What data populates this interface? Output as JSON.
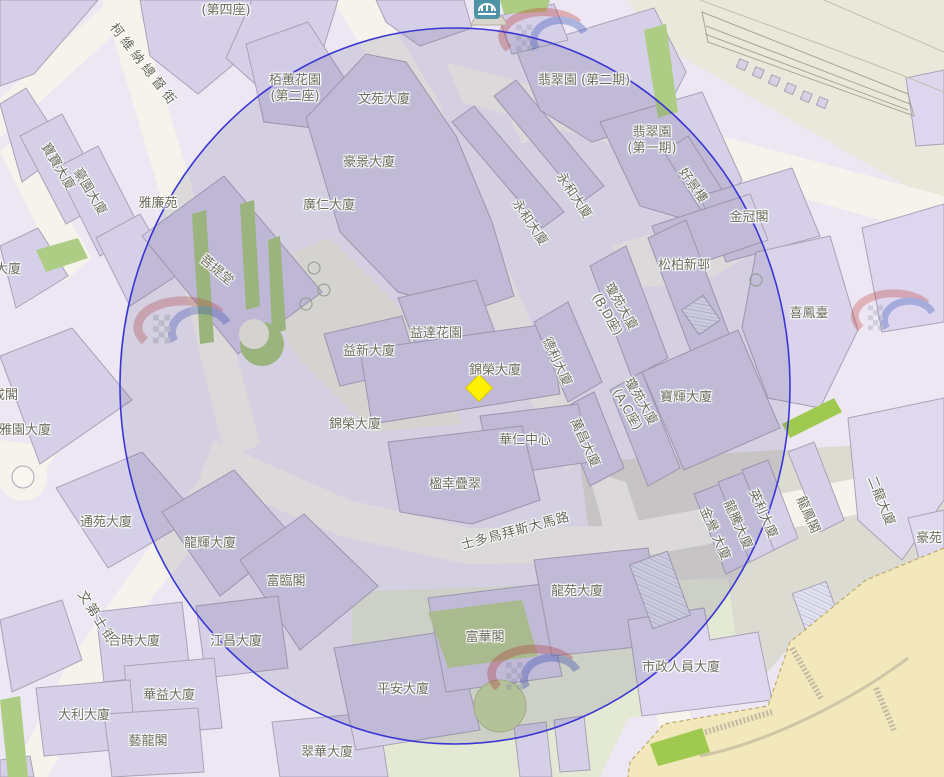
{
  "map": {
    "circle": {
      "cx": 455,
      "cy": 386,
      "rx": 335,
      "ry": 358,
      "stroke": "#3a36d6",
      "fill": "rgba(84,78,130,0.16)"
    },
    "marker": {
      "x": 479,
      "y": 388,
      "size": 19,
      "fill": "#fff100",
      "stroke": "#d9c400"
    },
    "poi_icon": {
      "x": 473,
      "y": -7,
      "bg": "#4e93a6"
    },
    "palette": {
      "building": "#d6cfe8",
      "building_light": "#ddd6ee",
      "road": "#f5f3eb",
      "green": "#a9c87e",
      "park": "#e4e9d3",
      "hill": "#f2e8bc",
      "paved": "#dcdbd2"
    }
  },
  "labels": [
    {
      "t": "(第四座)",
      "x": 226,
      "y": 11,
      "r": 0
    },
    {
      "t": "柯維納總督街",
      "x": 143,
      "y": 66,
      "r": 52,
      "s": true,
      "ls": 4
    },
    {
      "t": "寶寶大廈",
      "x": 57,
      "y": 167,
      "r": 59
    },
    {
      "t": "豪園大廈",
      "x": 89,
      "y": 192,
      "r": 59
    },
    {
      "t": "雅廉苑",
      "x": 158,
      "y": 204,
      "r": 0
    },
    {
      "t": "栢蕙花園\n(第二座)",
      "x": 295,
      "y": 89,
      "r": 0
    },
    {
      "t": "文苑大廈",
      "x": 384,
      "y": 100,
      "r": 0
    },
    {
      "t": "豪景大廈",
      "x": 369,
      "y": 163,
      "r": 0
    },
    {
      "t": "廣仁大廈",
      "x": 329,
      "y": 206,
      "r": 0
    },
    {
      "t": "菩提堂",
      "x": 216,
      "y": 271,
      "r": 40
    },
    {
      "t": "翡翠園 (第二期)",
      "x": 584,
      "y": 81,
      "r": 0
    },
    {
      "t": "翡翠園\n(第一期)",
      "x": 652,
      "y": 141,
      "r": 0
    },
    {
      "t": "永和大廈",
      "x": 573,
      "y": 196,
      "r": 56
    },
    {
      "t": "永和大廈",
      "x": 529,
      "y": 223,
      "r": 56
    },
    {
      "t": "好景樓",
      "x": 692,
      "y": 186,
      "r": 55
    },
    {
      "t": "金冠閣",
      "x": 749,
      "y": 218,
      "r": 0
    },
    {
      "t": "松柏新邨",
      "x": 684,
      "y": 266,
      "r": 0
    },
    {
      "t": "喜鳳臺",
      "x": 809,
      "y": 314,
      "r": 0
    },
    {
      "t": "瓊苑大廈\n(B,D座)",
      "x": 613,
      "y": 311,
      "r": 60
    },
    {
      "t": "瓊苑大廈\n(A,C座)",
      "x": 633,
      "y": 406,
      "r": 60
    },
    {
      "t": "寶輝大廈",
      "x": 686,
      "y": 398,
      "r": 0
    },
    {
      "t": "益達花園",
      "x": 436,
      "y": 334,
      "r": 0
    },
    {
      "t": "益新大廈",
      "x": 369,
      "y": 352,
      "r": 0
    },
    {
      "t": "錦榮大廈",
      "x": 495,
      "y": 371,
      "r": 0
    },
    {
      "t": "錦榮大廈",
      "x": 355,
      "y": 425,
      "r": 0
    },
    {
      "t": "德利大廈",
      "x": 556,
      "y": 362,
      "r": 65
    },
    {
      "t": "萬昌大廈",
      "x": 584,
      "y": 443,
      "r": 65
    },
    {
      "t": "華仁中心",
      "x": 525,
      "y": 441,
      "r": 0
    },
    {
      "t": "楹幸疊翠",
      "x": 455,
      "y": 485,
      "r": 0
    },
    {
      "t": "通苑大廈",
      "x": 106,
      "y": 523,
      "r": 0
    },
    {
      "t": "龍輝大廈",
      "x": 210,
      "y": 544,
      "r": 0
    },
    {
      "t": "富臨閣",
      "x": 286,
      "y": 582,
      "r": 0
    },
    {
      "t": "士多鳥拜斯大馬路",
      "x": 516,
      "y": 532,
      "r": -15,
      "s": true,
      "ls": 1
    },
    {
      "t": "龍苑大廈",
      "x": 577,
      "y": 592,
      "r": 0
    },
    {
      "t": "富華閣",
      "x": 485,
      "y": 638,
      "r": 0
    },
    {
      "t": "平安大廈",
      "x": 403,
      "y": 690,
      "r": 0
    },
    {
      "t": "市政人員大廈",
      "x": 681,
      "y": 668,
      "r": 0
    },
    {
      "t": "文第士街",
      "x": 96,
      "y": 618,
      "r": 58,
      "s": true,
      "ls": 2
    },
    {
      "t": "合時大廈",
      "x": 134,
      "y": 642,
      "r": 0
    },
    {
      "t": "江昌大廈",
      "x": 236,
      "y": 642,
      "r": 0
    },
    {
      "t": "華益大廈",
      "x": 169,
      "y": 696,
      "r": 0
    },
    {
      "t": "大利大廈",
      "x": 84,
      "y": 716,
      "r": 0
    },
    {
      "t": "藝龍閣",
      "x": 148,
      "y": 742,
      "r": 0
    },
    {
      "t": "翠華大廈",
      "x": 327,
      "y": 753,
      "r": 0
    },
    {
      "t": "金譽 大廈",
      "x": 714,
      "y": 534,
      "r": 66
    },
    {
      "t": "龍騰大廈",
      "x": 737,
      "y": 525,
      "r": 66
    },
    {
      "t": "英利大廈",
      "x": 762,
      "y": 514,
      "r": 66
    },
    {
      "t": "龍鳳閣",
      "x": 807,
      "y": 515,
      "r": 66
    },
    {
      "t": "二龍大廈",
      "x": 880,
      "y": 501,
      "r": 68
    },
    {
      "t": "豪苑",
      "x": 929,
      "y": 539,
      "r": 0
    },
    {
      "t": "雅園大廈",
      "x": 25,
      "y": 431,
      "r": 0
    },
    {
      "t": "成閣",
      "x": 5,
      "y": 396,
      "r": 0
    },
    {
      "t": "大廈",
      "x": 8,
      "y": 270,
      "r": 0
    }
  ]
}
